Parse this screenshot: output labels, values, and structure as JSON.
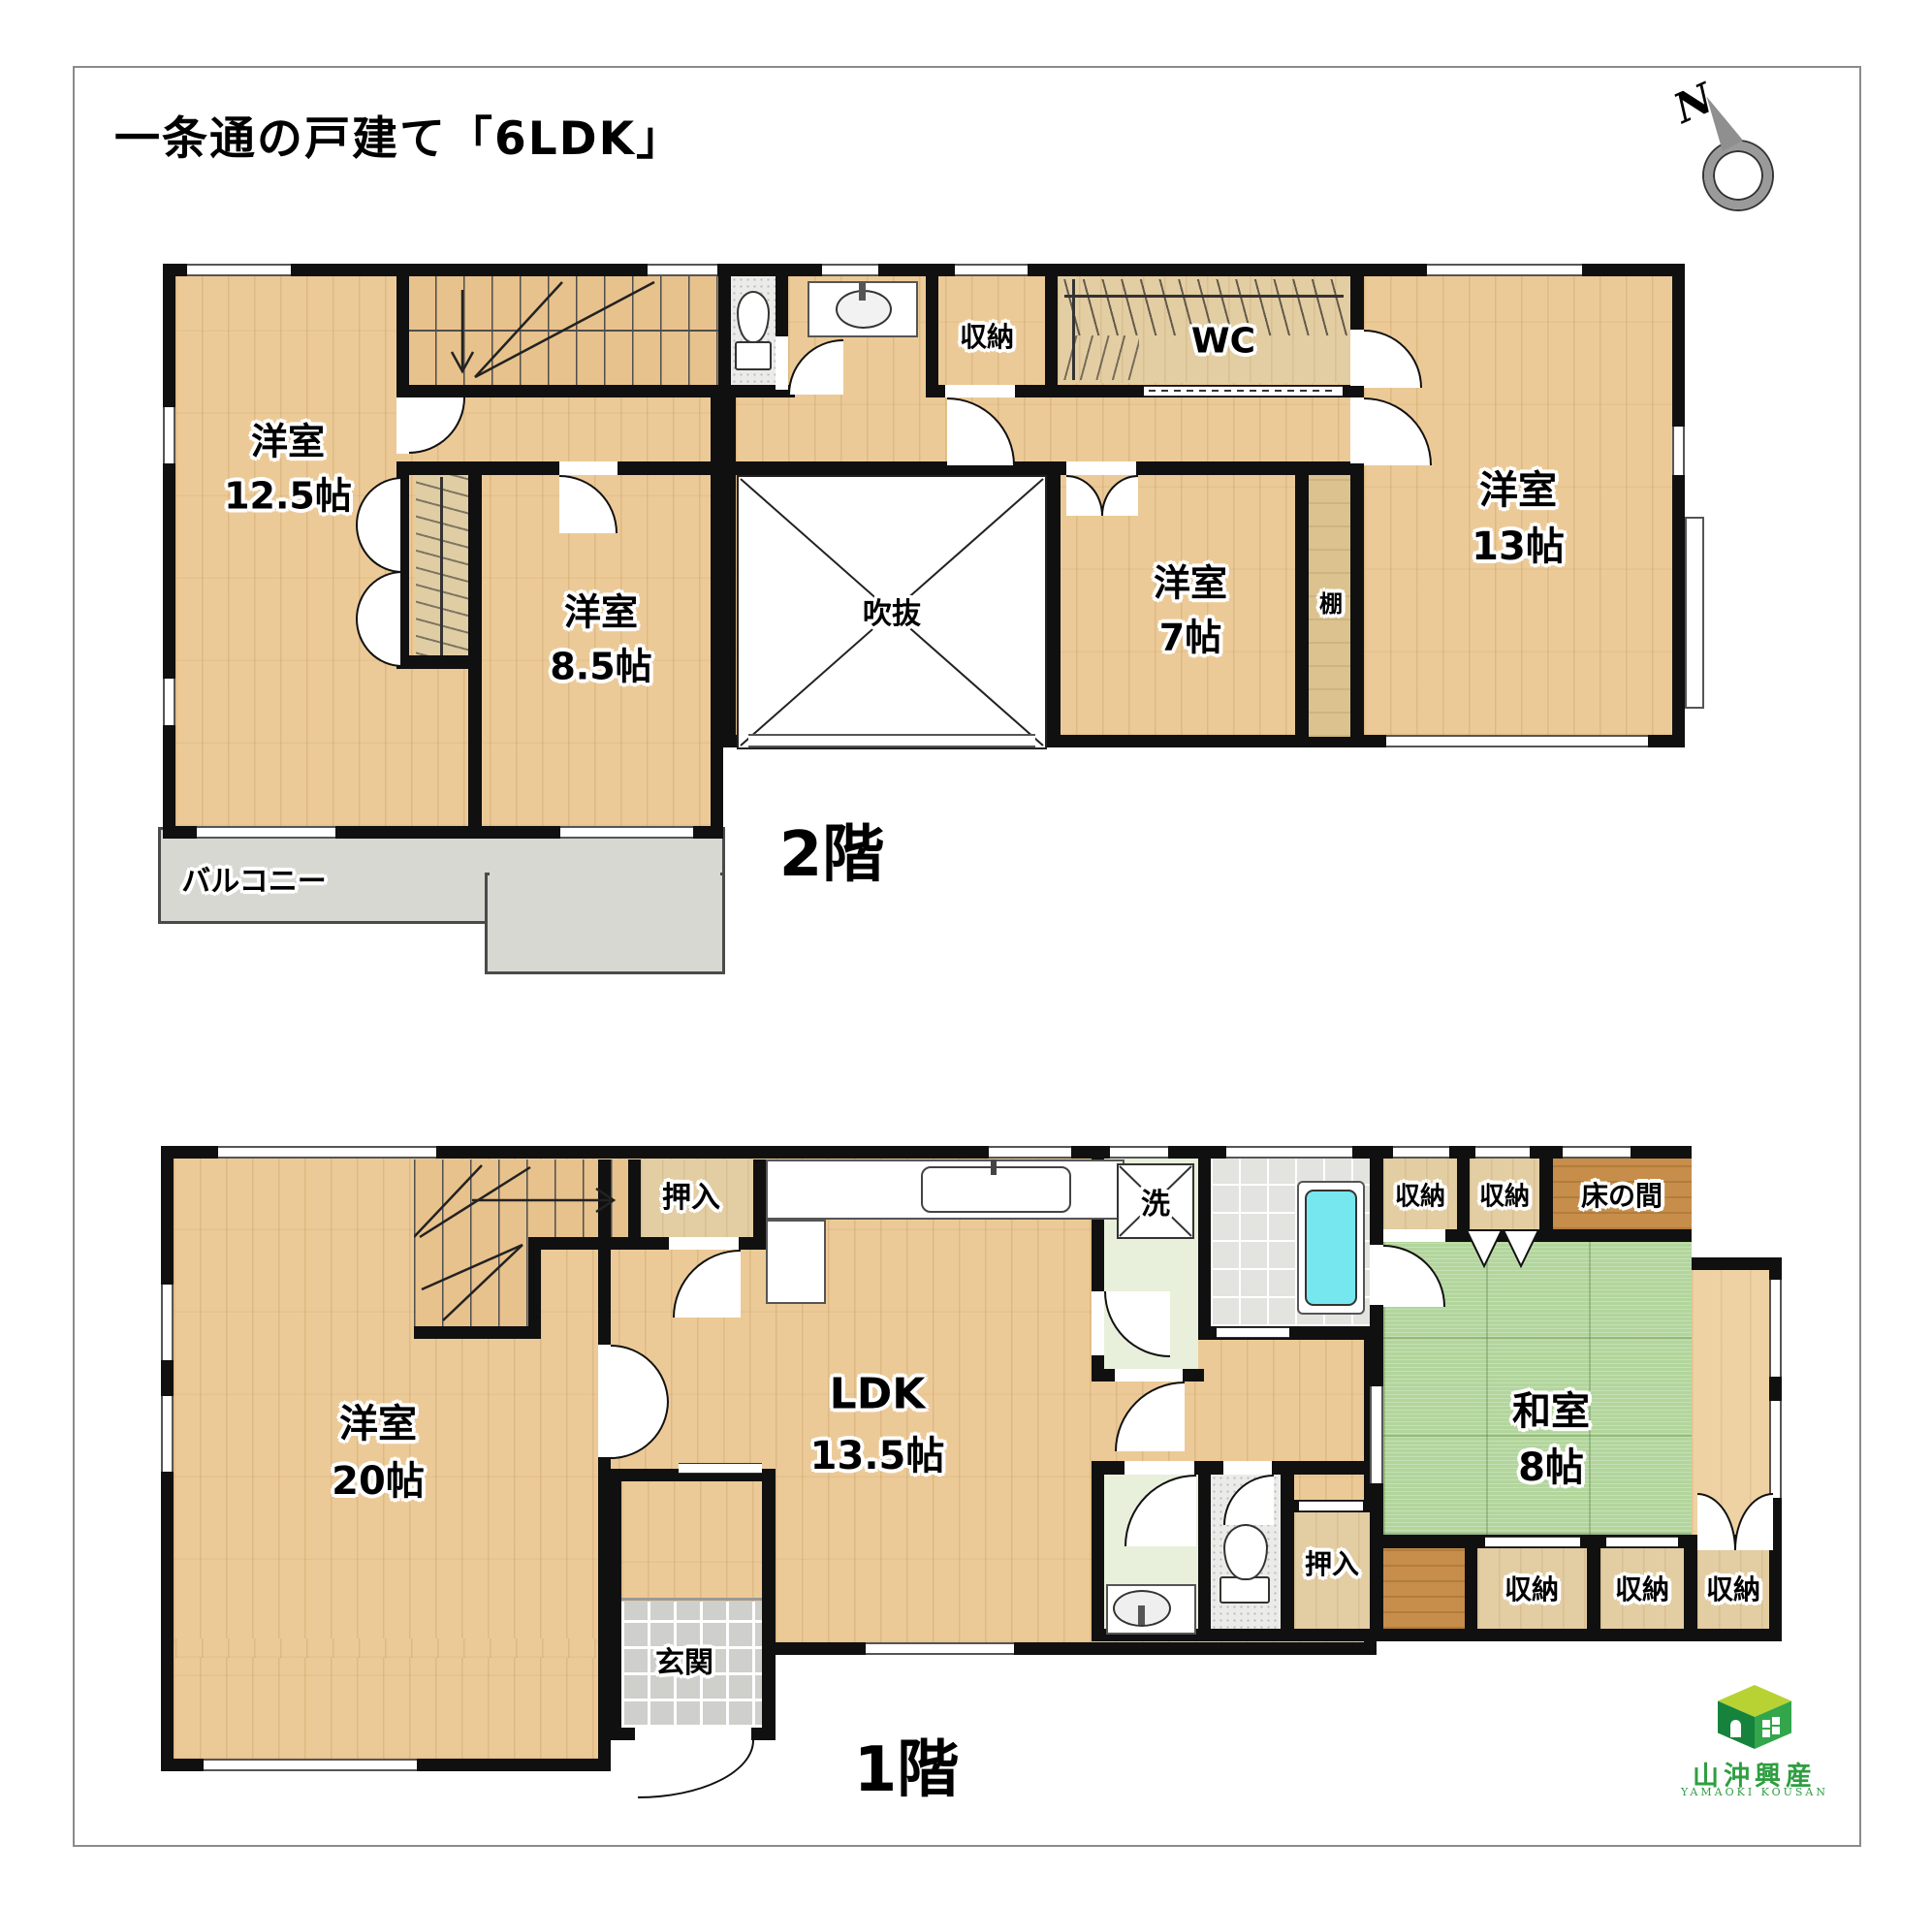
{
  "title": "一条通の戸建て「6LDK」",
  "compass": {
    "north": "N"
  },
  "floor2": {
    "floor_label": "2階",
    "room_yoshitsu125": {
      "name": "洋室",
      "size": "12.5帖"
    },
    "room_yoshitsu85": {
      "name": "洋室",
      "size": "8.5帖"
    },
    "room_yoshitsu7": {
      "name": "洋室",
      "size": "7帖"
    },
    "room_yoshitsu13": {
      "name": "洋室",
      "size": "13帖"
    },
    "void": {
      "label": "吹抜"
    },
    "storage": {
      "label": "収納"
    },
    "wc": {
      "label": "WC"
    },
    "shelf": {
      "label": "棚"
    },
    "balcony": {
      "label": "バルコニー"
    }
  },
  "floor1": {
    "floor_label": "1階",
    "room_yoshitsu20": {
      "name": "洋室",
      "size": "20帖"
    },
    "room_ldk": {
      "name": "LDK",
      "size": "13.5帖"
    },
    "room_washitsu": {
      "name": "和室",
      "size": "8帖"
    },
    "entrance": {
      "label": "玄関"
    },
    "laundry": {
      "label": "洗"
    },
    "closet_top": {
      "label": "押入"
    },
    "closet_bottom": {
      "label": "押入"
    },
    "storage_top1": {
      "label": "収納"
    },
    "storage_top2": {
      "label": "収納"
    },
    "tokonoma": {
      "label": "床の間"
    },
    "storage_b1": {
      "label": "収納"
    },
    "storage_b2": {
      "label": "収納"
    },
    "storage_b3": {
      "label": "収納"
    }
  },
  "logo": {
    "company": "山沖興産",
    "company_en": "YAMAOKI KOUSAN"
  },
  "colors": {
    "wood": "#ecca97",
    "tatami": "#b2d59c",
    "balcony": "#d8d8d3",
    "tub": "#76e7ee",
    "wall": "#101010",
    "logo_green": "#2f9e41"
  }
}
